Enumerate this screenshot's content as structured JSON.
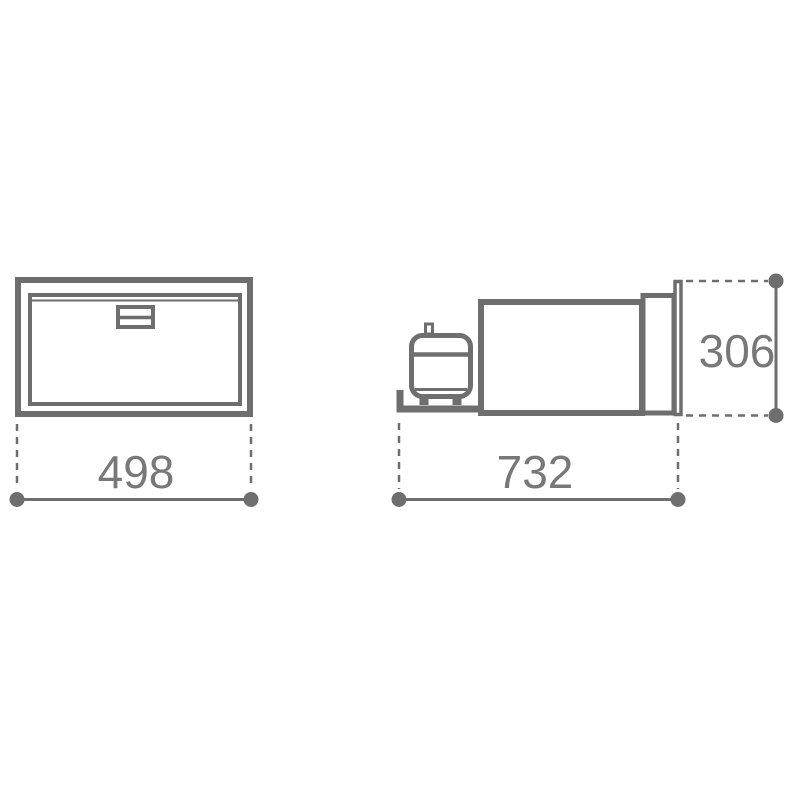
{
  "colors": {
    "line": "#6e6e6e",
    "text": "#787878",
    "bg": "#ffffff"
  },
  "dimensions": {
    "width": "498",
    "depth": "732",
    "height": "306"
  }
}
